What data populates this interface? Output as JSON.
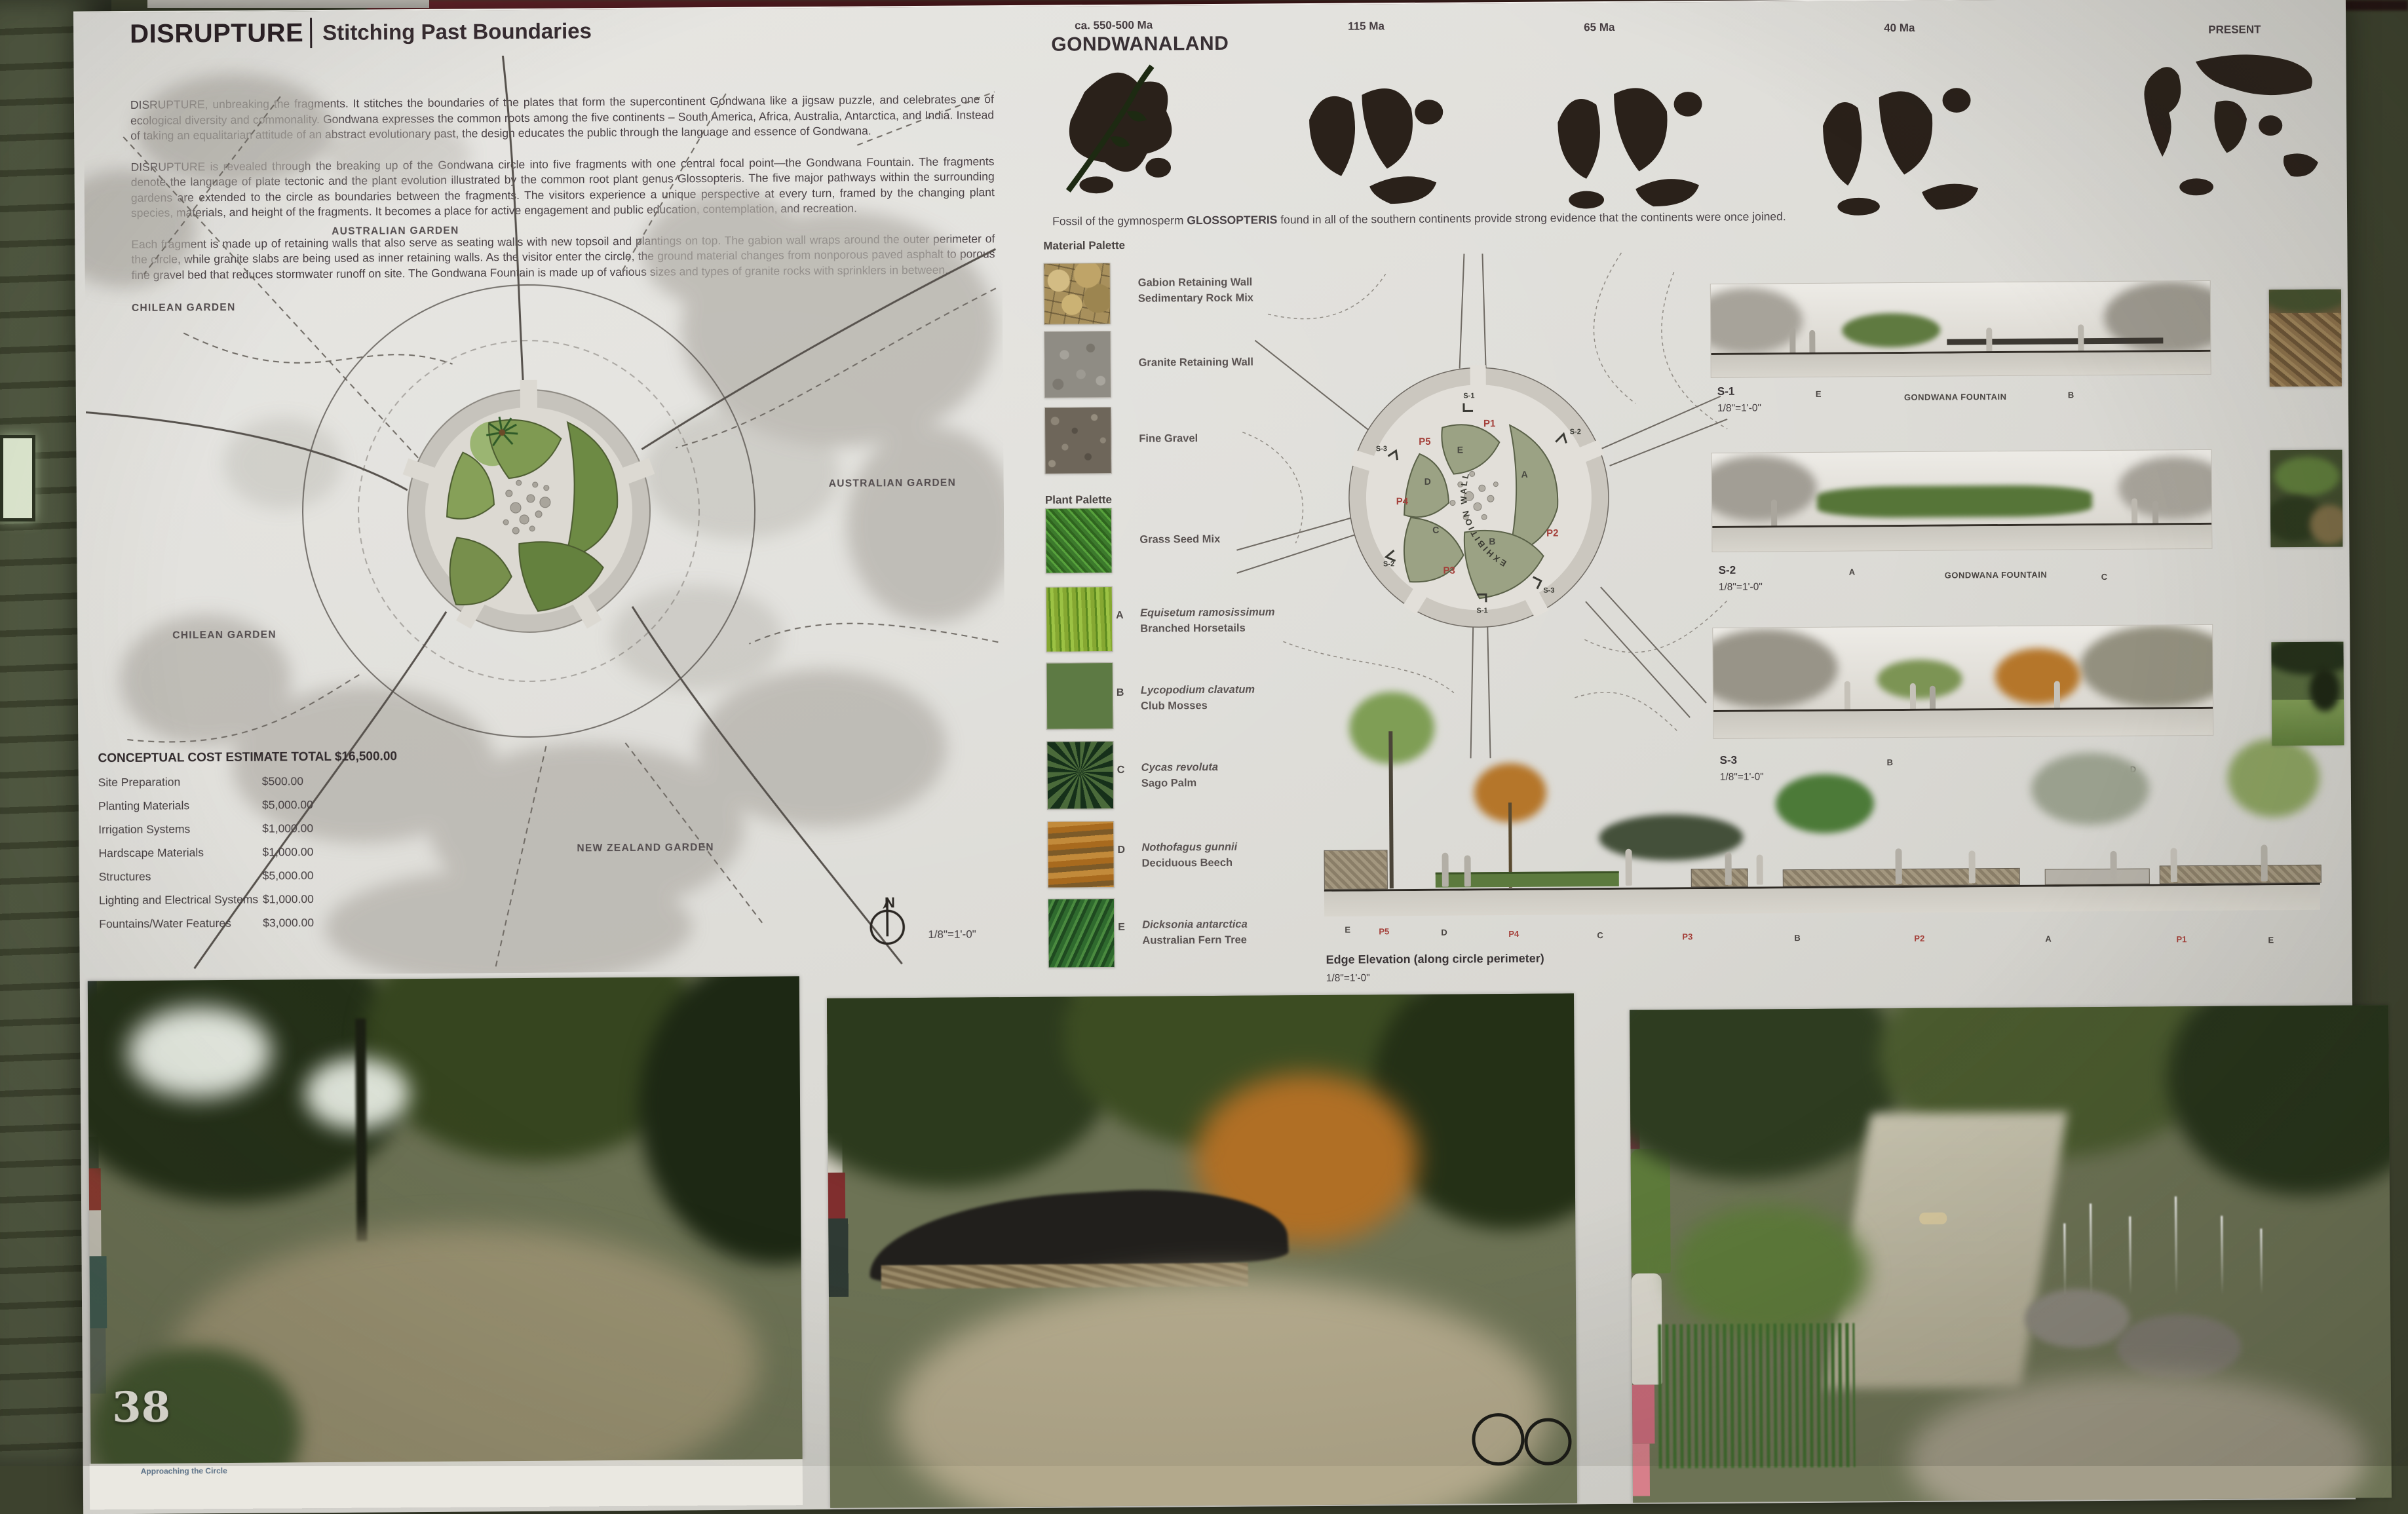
{
  "page_number": "38",
  "header": {
    "title": "DISRUPTURE",
    "subtitle": "Stitching Past Boundaries"
  },
  "intro": {
    "p1": "DISRUPTURE, unbreaking the fragments.  It stitches the boundaries of the plates that form the supercontinent Gondwana like a jigsaw puzzle, and celebrates one of ecological diversity and commonality.  Gondwana expresses the common roots among the five continents – South America, Africa, Australia, Antarctica, and India.  Instead of taking an equalitarian attitude of an abstract evolutionary past, the design educates the public through the language and essence of Gondwana.",
    "p2": "DISRUPTURE is revealed through the breaking up of the Gondwana circle into five fragments with one central focal point—the Gondwana Fountain. The fragments denote the language of plate tectonic and the plant evolution illustrated by the common root plant genus Glossopteris.  The five major pathways within the surrounding gardens are extended to the circle as boundaries between the fragments.  The visitors experience a unique perspective at every turn, framed by the changing plant species, materials, and height of the fragments.  It becomes a place for active engagement and public education, contemplation, and recreation.",
    "p3": "Each fragment is made up of retaining walls that also serve as seating walls with new topsoil and plantings on top.  The gabion wall wraps around the outer perimeter of the circle, while granite slabs are being used as inner retaining walls.  As the visitor enter the circle, the ground material changes from nonporous paved asphalt to porous fine gravel bed that reduces stormwater runoff on site.  The Gondwana Fountain is made up of various sizes and types of granite rocks with sprinklers in between."
  },
  "master_plan": {
    "garden_labels": [
      "CHILEAN GARDEN",
      "AUSTRALIAN GARDEN",
      "AUSTRALIAN GARDEN",
      "CHILEAN GARDEN",
      "NEW ZEALAND GARDEN"
    ],
    "north_label": "N",
    "scale": "1/8\"=1'-0\""
  },
  "cost_estimate": {
    "title": "CONCEPTUAL COST ESTIMATE TOTAL $16,500.00",
    "items": [
      {
        "label": "Site Preparation",
        "amount": "$500.00"
      },
      {
        "label": "Planting Materials",
        "amount": "$5,000.00"
      },
      {
        "label": "Irrigation Systems",
        "amount": "$1,000.00"
      },
      {
        "label": "Hardscape Materials",
        "amount": "$1,000.00"
      },
      {
        "label": "Structures",
        "amount": "$5,000.00"
      },
      {
        "label": "Lighting and Electrical Systems",
        "amount": "$1,000.00"
      },
      {
        "label": "Fountains/Water Features",
        "amount": "$3,000.00"
      }
    ]
  },
  "timeline": {
    "stages": [
      {
        "era": "ca. 550-500 Ma",
        "name": "GONDWANALAND"
      },
      {
        "era": "115 Ma"
      },
      {
        "era": "65 Ma"
      },
      {
        "era": "40 Ma"
      },
      {
        "era": "PRESENT"
      }
    ]
  },
  "fossil_note": {
    "prefix": "Fossil of the gymnosperm ",
    "term": "GLOSSOPTERIS",
    "suffix": " found in all of the southern continents provide strong evidence that the continents were once joined."
  },
  "material_palette": {
    "header": "Material Palette",
    "items": [
      {
        "name": "Gabion Retaining Wall",
        "sub": "Sedimentary Rock Mix"
      },
      {
        "name": "Granite Retaining Wall",
        "sub": ""
      },
      {
        "name": "Fine Gravel",
        "sub": ""
      }
    ]
  },
  "plant_palette": {
    "header": "Plant Palette",
    "items": [
      {
        "letter": "",
        "latin": "",
        "common": "Grass Seed Mix"
      },
      {
        "letter": "A",
        "latin": "Equisetum ramosissimum",
        "common": "Branched Horsetails"
      },
      {
        "letter": "B",
        "latin": "Lycopodium clavatum",
        "common": "Club Mosses"
      },
      {
        "letter": "C",
        "latin": "Cycas revoluta",
        "common": "Sago Palm"
      },
      {
        "letter": "D",
        "latin": "Nothofagus gunnii",
        "common": "Deciduous Beech"
      },
      {
        "letter": "E",
        "latin": "Dicksonia antarctica",
        "common": "Australian Fern Tree"
      }
    ]
  },
  "detail_plan": {
    "wall_label": "EXHIBITION WALL",
    "fragments": [
      "A",
      "B",
      "C",
      "D",
      "E"
    ],
    "paths": [
      "P1",
      "P2",
      "P3",
      "P4",
      "P5"
    ],
    "sections": [
      "S-1",
      "S-2",
      "S-3"
    ]
  },
  "sections": [
    {
      "id": "S-1",
      "scale": "1/8\"=1'-0\"",
      "left": "E",
      "center": "GONDWANA FOUNTAIN",
      "right": "B"
    },
    {
      "id": "S-2",
      "scale": "1/8\"=1'-0\"",
      "left": "A",
      "center": "GONDWANA FOUNTAIN",
      "right": "C"
    },
    {
      "id": "S-3",
      "scale": "1/8\"=1'-0\"",
      "left": "B",
      "center": "",
      "right": "D"
    }
  ],
  "edge_elevation": {
    "title": "Edge Elevation (along circle perimeter)",
    "scale": "1/8\"=1'-0\"",
    "labels": [
      "E",
      "P5",
      "D",
      "P4",
      "C",
      "P3",
      "B",
      "P2",
      "A",
      "P1",
      "E"
    ]
  },
  "photo_caption_fragment": "Approaching the Circle",
  "colors": {
    "accent_red": "#a4403a",
    "fragment_green": "#9ba284",
    "canopy_gray": "#b2afa8"
  }
}
